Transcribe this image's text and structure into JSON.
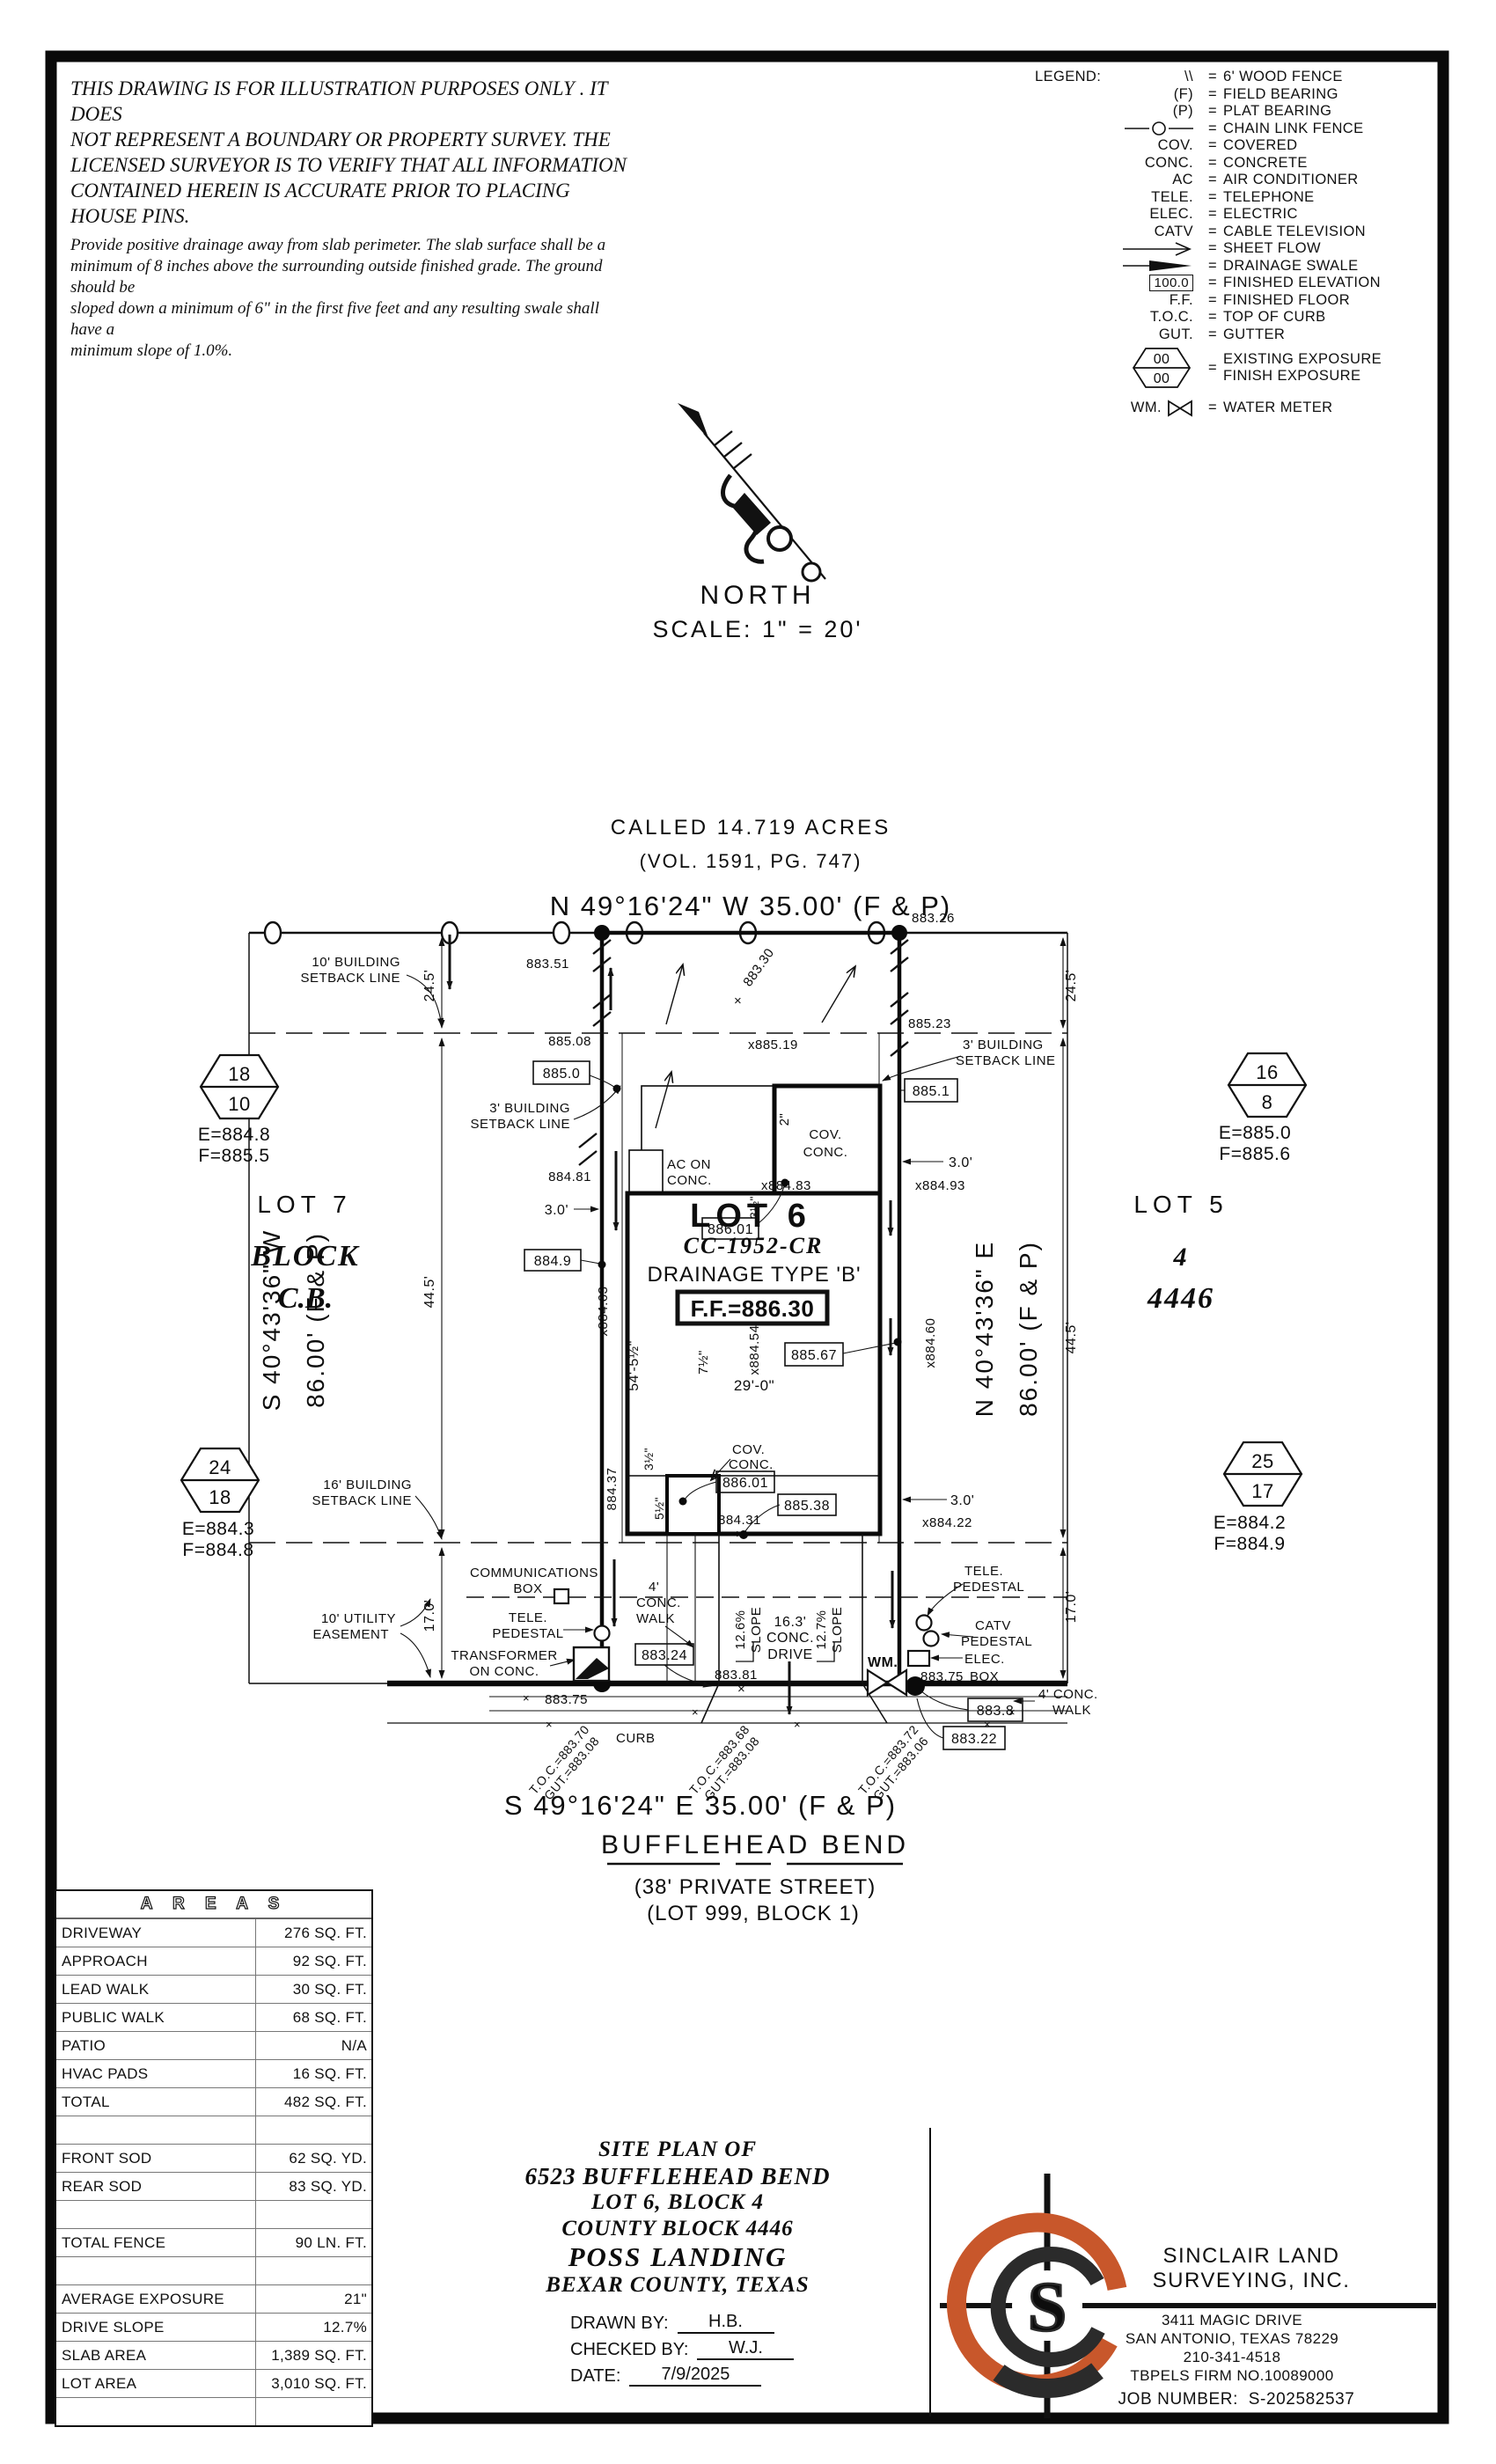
{
  "colors": {
    "ink": "#111111",
    "accent": "#c8572b",
    "grid": "#777777"
  },
  "disclaimer": {
    "p1": [
      "THIS DRAWING IS FOR ILLUSTRATION PURPOSES ONLY . IT DOES",
      "NOT REPRESENT A BOUNDARY OR PROPERTY SURVEY. THE",
      "LICENSED SURVEYOR IS TO VERIFY THAT ALL INFORMATION",
      "CONTAINED HEREIN IS ACCURATE PRIOR TO PLACING HOUSE PINS."
    ],
    "p2": [
      "Provide positive drainage away from slab perimeter. The slab surface shall be a",
      "minimum of 8 inches above the surrounding outside finished grade. The ground should be",
      "sloped down a minimum of 6\" in the first five feet and any resulting swale shall have a",
      "minimum slope of 1.0%."
    ]
  },
  "legend": {
    "title": "LEGEND:",
    "eq": "=",
    "items": [
      {
        "sym": "\\\\",
        "desc": "6' WOOD FENCE"
      },
      {
        "sym": "(F)",
        "desc": "FIELD BEARING"
      },
      {
        "sym": "(P)",
        "desc": "PLAT BEARING"
      },
      {
        "sym": "",
        "desc": "CHAIN LINK FENCE"
      },
      {
        "sym": "COV.",
        "desc": "COVERED"
      },
      {
        "sym": "CONC.",
        "desc": "CONCRETE"
      },
      {
        "sym": "AC",
        "desc": "AIR CONDITIONER"
      },
      {
        "sym": "TELE.",
        "desc": "TELEPHONE"
      },
      {
        "sym": "ELEC.",
        "desc": "ELECTRIC"
      },
      {
        "sym": "CATV",
        "desc": "CABLE TELEVISION"
      },
      {
        "sym": "",
        "desc": "SHEET FLOW"
      },
      {
        "sym": "",
        "desc": "DRAINAGE SWALE"
      },
      {
        "sym": "100.0",
        "desc": "FINISHED ELEVATION"
      },
      {
        "sym": "F.F.",
        "desc": "FINISHED FLOOR"
      },
      {
        "sym": "T.O.C.",
        "desc": "TOP OF CURB"
      },
      {
        "sym": "GUT.",
        "desc": "GUTTER"
      },
      {
        "sym": "00",
        "sym2": "00",
        "desc": "EXISTING EXPOSURE",
        "desc2": "FINISH EXPOSURE"
      },
      {
        "sym": "WM.",
        "desc": "WATER METER"
      }
    ]
  },
  "north": {
    "label": "NORTH",
    "scale": "SCALE: 1\" = 20'"
  },
  "plan": {
    "called": "CALLED 14.719 ACRES",
    "vol": "(VOL. 1591, PG. 747)",
    "bearing_top": "N 49°16'24\" W  35.00'  (F & P)",
    "bearing_bottom": "S 49°16'24\" E  35.00'  (F & P)",
    "bearing_side_w1": "S 40°43'36\" W",
    "bearing_side_w2": "86.00' (F & P)",
    "bearing_side_e1": "N 40°43'36\" E",
    "bearing_side_e2": "86.00' (F & P)",
    "street": "BUFFLEHEAD BEND",
    "street_sub1": "(38' PRIVATE STREET)",
    "street_sub2": "(LOT 999, BLOCK 1)",
    "lot6": "LOT 6",
    "plat": "CC-1952-CR",
    "drainage": "DRAINAGE TYPE 'B'",
    "ff": "F.F.=886.30",
    "lot7": "LOT 7",
    "block_w1": "BLOCK",
    "block_w2": "C.B.",
    "lot5": "LOT 5",
    "block_e1": "4",
    "block_e2": "4446",
    "hex_nw": {
      "a": "18",
      "b": "10",
      "e": "E=884.8",
      "f": "F=885.5"
    },
    "hex_ne": {
      "a": "16",
      "b": "8",
      "e": "E=885.0",
      "f": "F=885.6"
    },
    "hex_sw": {
      "a": "24",
      "b": "18",
      "e": "E=884.3",
      "f": "F=884.8"
    },
    "hex_se": {
      "a": "25",
      "b": "17",
      "e": "E=884.2",
      "f": "F=884.9"
    },
    "lbl_setback10_1": "10' BUILDING",
    "lbl_setback10_2": "SETBACK LINE",
    "lbl_setback3_1": "3' BUILDING",
    "lbl_setback3_2": "SETBACK LINE",
    "lbl_setback16_1": "16' BUILDING",
    "lbl_setback16_2": "SETBACK LINE",
    "lbl_easement_1": "10' UTILITY",
    "lbl_easement_2": "EASEMENT",
    "lbl_comm1": "COMMUNICATIONS",
    "lbl_comm2": "BOX",
    "lbl_tele1": "TELE.",
    "lbl_tele2": "PEDESTAL",
    "lbl_trans1": "TRANSFORMER",
    "lbl_trans2": "ON CONC.",
    "lbl_catv1": "CATV",
    "lbl_catv2": "PEDESTAL",
    "lbl_elec1": "ELEC.",
    "lbl_elec2": "BOX",
    "lbl_wm": "WM.",
    "lbl_ac1": "AC ON",
    "lbl_ac2": "CONC.",
    "lbl_cov1": "COV.",
    "lbl_cov2": "CONC.",
    "lbl_curb": "CURB",
    "lbl_walk_a": "4'",
    "lbl_walk_b": "CONC.",
    "lbl_walk_c": "WALK",
    "lbl_walk_r1": "4' CONC.",
    "lbl_walk_r2": "WALK",
    "lbl_drive1": "16.3'",
    "lbl_drive2": "CONC.",
    "lbl_drive3": "DRIVE",
    "slope_a": "12.6%",
    "slope_b": "12.7%",
    "slope_word": "SLOPE",
    "d24_5": "24.5'",
    "d44_5": "44.5'",
    "d17": "17.0'",
    "d3": "3.0'",
    "d29": "29'-0\"",
    "d54": "54'-5½\"",
    "d7h": "7½\"",
    "d2in": "2\"",
    "d3h": "3½\"",
    "d5h": "5½\"",
    "el_883_51": "883.51",
    "el_883_26": "883.26",
    "el_885_08": "885.08",
    "el_885_19": "x885.19",
    "el_885_23": "885.23",
    "el_885_0": "885.0",
    "el_885_1": "885.1",
    "el_884_81": "884.81",
    "el_884_93": "x884.93",
    "el_886_01": "886.01",
    "el_884_83": "x884.83",
    "el_884_9": "884.9",
    "el_883_30": "883.30",
    "el_884_63": "x884.63",
    "el_884_54": "x884.54",
    "el_884_60": "x884.60",
    "el_885_67": "885.67",
    "el_884_37": "884.37",
    "el_885_38": "885.38",
    "el_884_31": "884.31",
    "el_884_22": "x884.22",
    "el_883_24": "883.24",
    "el_883_81": "883.81",
    "el_883_75": "883.75",
    "el_883_8": "883.8",
    "el_883_22": "883.22",
    "toc1": "T.O.C.=883.70",
    "gut1": "GUT.=883.08",
    "toc2": "T.O.C.=883.68",
    "gut2": "GUT.=883.08",
    "toc3": "T.O.C.=883.72",
    "gut3": "GUT.=883.06",
    "xmark": "×"
  },
  "areas_table": {
    "title": "A R E A S",
    "rows": [
      {
        "label": "DRIVEWAY",
        "value": "276 SQ. FT."
      },
      {
        "label": "APPROACH",
        "value": "92 SQ. FT."
      },
      {
        "label": "LEAD WALK",
        "value": "30 SQ. FT."
      },
      {
        "label": "PUBLIC WALK",
        "value": "68 SQ. FT."
      },
      {
        "label": "PATIO",
        "value": "N/A"
      },
      {
        "label": "HVAC PADS",
        "value": "16 SQ. FT."
      },
      {
        "label": "TOTAL",
        "value": "482 SQ. FT."
      },
      {
        "label": "",
        "value": ""
      },
      {
        "label": "FRONT SOD",
        "value": "62 SQ. YD."
      },
      {
        "label": "REAR SOD",
        "value": "83 SQ. YD."
      },
      {
        "label": "",
        "value": ""
      },
      {
        "label": "TOTAL FENCE",
        "value": "90 LN. FT."
      },
      {
        "label": "",
        "value": ""
      },
      {
        "label": "AVERAGE EXPOSURE",
        "value": "21\""
      },
      {
        "label": "DRIVE SLOPE",
        "value": "12.7%"
      },
      {
        "label": "SLAB AREA",
        "value": "1,389 SQ. FT."
      },
      {
        "label": "LOT AREA",
        "value": "3,010 SQ. FT."
      },
      {
        "label": "",
        "value": ""
      }
    ]
  },
  "title_block": {
    "l1": "SITE PLAN OF",
    "l2": "6523 BUFFLEHEAD BEND",
    "l3": "LOT 6, BLOCK 4",
    "l4": "COUNTY BLOCK 4446",
    "l5": "POSS LANDING",
    "l6": "BEXAR COUNTY, TEXAS",
    "drawn_label": "DRAWN BY:",
    "drawn": "H.B.",
    "checked_label": "CHECKED BY:",
    "checked": "W.J.",
    "date_label": "DATE:",
    "date": "7/9/2025"
  },
  "company": {
    "name1": "SINCLAIR LAND",
    "name2": "SURVEYING, INC.",
    "addr1": "3411 MAGIC DRIVE",
    "addr2": "SAN ANTONIO, TEXAS 78229",
    "phone": "210-341-4518",
    "firm": "TBPELS FIRM NO.10089000",
    "job_label": "JOB NUMBER:",
    "job": "S-202582537",
    "monogram": "S"
  }
}
